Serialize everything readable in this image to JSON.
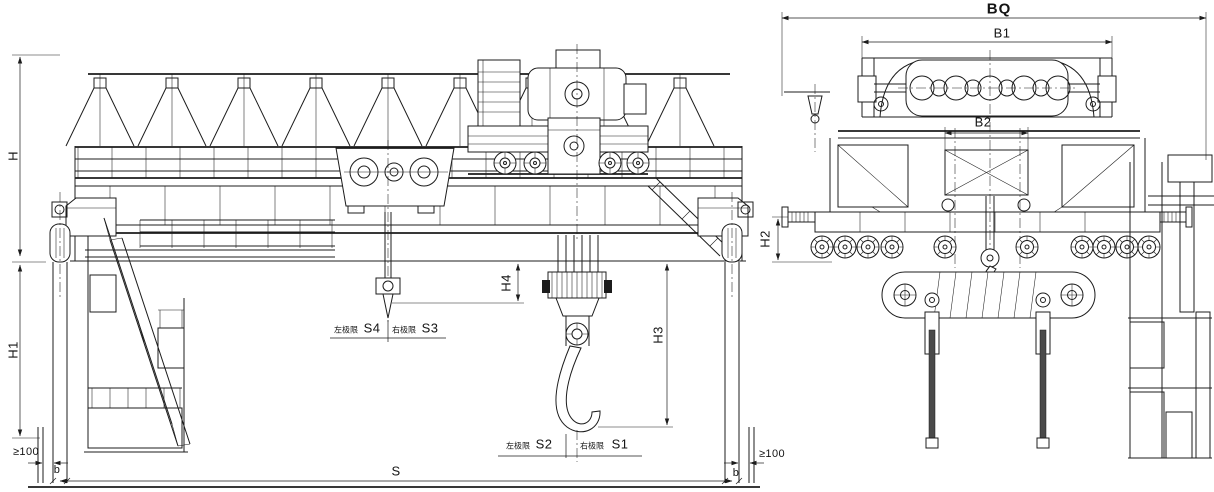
{
  "front_view": {
    "dimensions": {
      "bridge_height": "H",
      "leg_height": "H1",
      "aux_hook_clearance": "H4",
      "main_hook_clearance": "H3",
      "span": "S",
      "end_clearance_left": "≥100",
      "end_clearance_right": "≥100",
      "rail_width_left": "b",
      "rail_width_right": "b"
    },
    "hook_limits": {
      "aux_left_label": "左极限",
      "aux_left_value": "S4",
      "aux_right_label": "右极限",
      "aux_right_value": "S3",
      "main_left_label": "左极限",
      "main_left_value": "S2",
      "main_right_label": "右极限",
      "main_right_value": "S1"
    }
  },
  "side_view": {
    "dimensions": {
      "overall_width": "BQ",
      "trolley_frame_width": "B1",
      "trolley_gauge": "B2",
      "buffer_height": "H2"
    }
  },
  "colors": {
    "line": "#1c1c1c",
    "background": "#ffffff"
  }
}
